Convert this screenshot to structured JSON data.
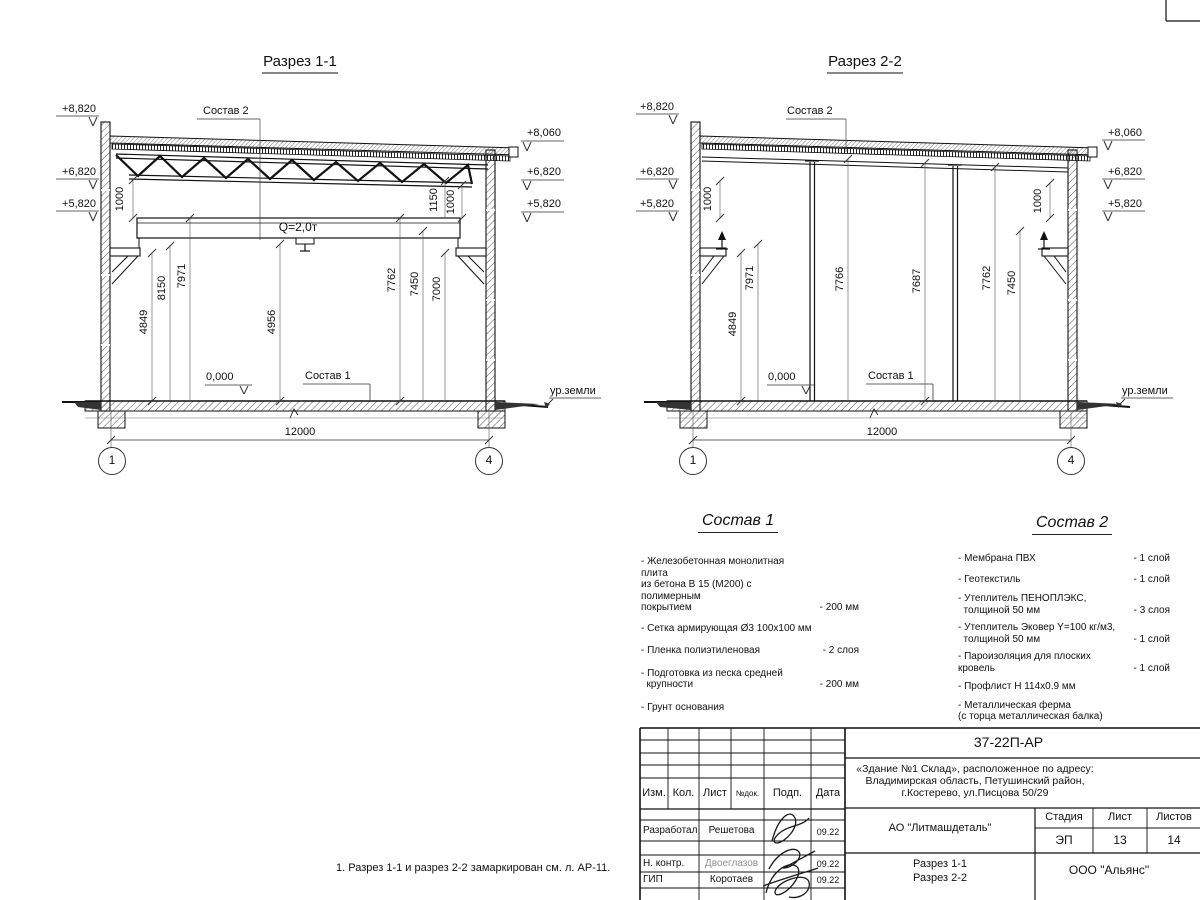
{
  "sections": [
    {
      "title": "Разрез 1-1",
      "elev_left": [
        "+8,820",
        "+6,820",
        "+5,820"
      ],
      "elev_right": [
        "+8,060",
        "+6,820",
        "+5,820"
      ],
      "sostav2_label": "Состав 2",
      "sostav1_label": "Состав 1",
      "zero": "0,000",
      "ground": "ур.земли",
      "crane": "Q=2,0т",
      "dim_1000_left": "1000",
      "dim_1150": "1150",
      "dim_1000_right": "1000",
      "dims": [
        "4849",
        "8150",
        "7971",
        "4956",
        "7762",
        "7450",
        "7000"
      ],
      "span": "12000",
      "axes": [
        "1",
        "4"
      ]
    },
    {
      "title": "Разрез 2-2",
      "elev_left": [
        "+8,820",
        "+6,820",
        "+5,820"
      ],
      "elev_right": [
        "+8,060",
        "+6,820",
        "+5,820"
      ],
      "sostav2_label": "Состав 2",
      "sostav1_label": "Состав 1",
      "zero": "0,000",
      "ground": "ур.земли",
      "dim_1000_left": "1000",
      "dim_1000_right": "1000",
      "dims": [
        "4849",
        "7971",
        "7766",
        "7687",
        "7762",
        "7450"
      ],
      "span": "12000",
      "axes": [
        "1",
        "4"
      ]
    }
  ],
  "compositions": [
    {
      "title": "Состав 1",
      "items": [
        {
          "lines": [
            "- Железобетонная  монолитная плита",
            "из бетона В 15 (М200) с полимерным",
            "покрытием"
          ],
          "value": "- 200 мм"
        },
        {
          "lines": [
            "- Сетка армирующая Ø3 100х100 мм"
          ],
          "value": ""
        },
        {
          "lines": [
            "- Пленка полиэтиленовая"
          ],
          "value": "-  2 слоя"
        },
        {
          "lines": [
            "- Подготовка из песка средней",
            "  крупности"
          ],
          "value": "- 200 мм"
        },
        {
          "lines": [
            "- Грунт основания"
          ],
          "value": ""
        }
      ]
    },
    {
      "title": "Состав 2",
      "items": [
        {
          "lines": [
            "- Мембрана ПВХ"
          ],
          "value": "- 1 слой"
        },
        {
          "lines": [
            "- Геотекстиль"
          ],
          "value": "- 1 слой"
        },
        {
          "lines": [
            "- Утеплитель ПЕНОПЛЭКС,",
            "  толщиной 50 мм"
          ],
          "value": "- 3 слоя"
        },
        {
          "lines": [
            "- Утеплитель Эковер Y=100 кг/м3,",
            "  толщиной 50 мм"
          ],
          "value": "- 1 слой"
        },
        {
          "lines": [
            "- Пароизоляция для плоских кровель"
          ],
          "value": "- 1 слой"
        },
        {
          "lines": [
            "- Профлист Н 114х0.9 мм"
          ],
          "value": ""
        },
        {
          "lines": [
            "- Металлическая ферма",
            "(с торца металлическая балка)"
          ],
          "value": ""
        }
      ]
    }
  ],
  "note": "1. Разрез 1-1 и разрез 2-2 замаркирован см. л. АР-11.",
  "titleblock": {
    "doc_number": "37-22П-АР",
    "object_lines": [
      "«Здание №1 Склад», расположенное по адресу:",
      "Владимирская область, Петушинский район,",
      "г.Костерево, ул.Писцова 50/29"
    ],
    "headers": {
      "izm": "Изм.",
      "kol": "Кол.",
      "list": "Лист",
      "ndok": "№док.",
      "podp": "Подп.",
      "data": "Дата"
    },
    "rows": [
      {
        "role": "Разработал",
        "name": "Решетова",
        "date": "09.22"
      },
      {
        "role": "Н. контр.",
        "name": "Двоеглазов",
        "date": "09.22"
      },
      {
        "role": "ГИП",
        "name": "Коротаев",
        "date": "09.22"
      }
    ],
    "company": "АО \"Литмашдеталь\"",
    "stage_label": "Стадия",
    "sheet_label": "Лист",
    "sheets_label": "Листов",
    "stage": "ЭП",
    "sheet": "13",
    "sheets": "14",
    "sheet_title_lines": [
      "Разрез 1-1",
      "Разрез 2-2"
    ],
    "org": "ООО \"Альянс\""
  }
}
